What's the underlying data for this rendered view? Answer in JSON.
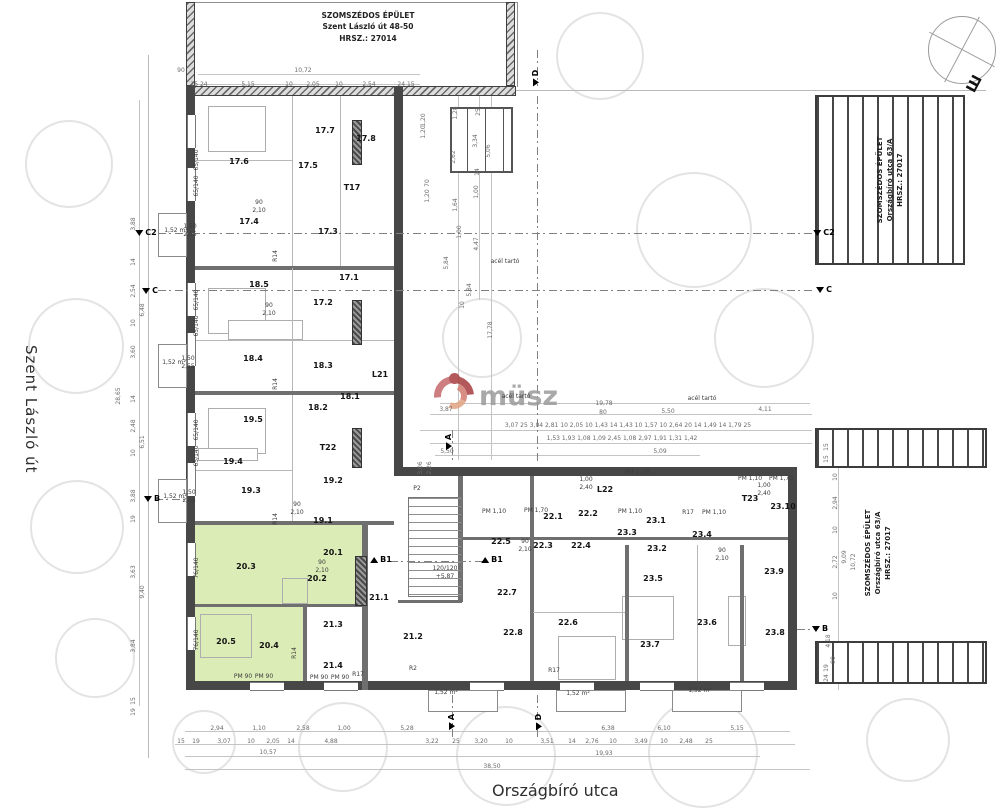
{
  "streets": {
    "left": "Szent László út",
    "bottom": "Országbíró utca"
  },
  "neighbor_top": {
    "l1": "SZOMSZÉDOS ÉPÜLET",
    "l2": "Szent László út 48-50",
    "l3": "HRSZ.: 27014"
  },
  "neighbor_right": {
    "l1": "SZOMSZÉDOS ÉPÜLET",
    "l2": "Országbíró utca 63/A",
    "l3": "HRSZ.: 27017"
  },
  "watermark": {
    "text": "müsz"
  },
  "rooms": [
    {
      "t": "17.1",
      "x": 349,
      "y": 278
    },
    {
      "t": "17.2",
      "x": 323,
      "y": 303
    },
    {
      "t": "17.3",
      "x": 328,
      "y": 232
    },
    {
      "t": "17.4",
      "x": 249,
      "y": 222
    },
    {
      "t": "17.5",
      "x": 308,
      "y": 166
    },
    {
      "t": "17.6",
      "x": 239,
      "y": 162
    },
    {
      "t": "17.7",
      "x": 325,
      "y": 131
    },
    {
      "t": "17.8",
      "x": 366,
      "y": 139
    },
    {
      "t": "T17",
      "x": 352,
      "y": 188
    },
    {
      "t": "18.1",
      "x": 350,
      "y": 397
    },
    {
      "t": "18.2",
      "x": 318,
      "y": 408
    },
    {
      "t": "18.3",
      "x": 323,
      "y": 366
    },
    {
      "t": "18.4",
      "x": 253,
      "y": 359
    },
    {
      "t": "18.5",
      "x": 259,
      "y": 285
    },
    {
      "t": "L21",
      "x": 380,
      "y": 375
    },
    {
      "t": "19.1",
      "x": 323,
      "y": 521
    },
    {
      "t": "19.2",
      "x": 333,
      "y": 481
    },
    {
      "t": "19.3",
      "x": 251,
      "y": 491
    },
    {
      "t": "19.4",
      "x": 233,
      "y": 462
    },
    {
      "t": "19.5",
      "x": 253,
      "y": 420
    },
    {
      "t": "T22",
      "x": 328,
      "y": 448
    },
    {
      "t": "20.1",
      "x": 333,
      "y": 553
    },
    {
      "t": "20.2",
      "x": 317,
      "y": 579
    },
    {
      "t": "20.3",
      "x": 246,
      "y": 567
    },
    {
      "t": "20.4",
      "x": 269,
      "y": 646
    },
    {
      "t": "20.5",
      "x": 226,
      "y": 642
    },
    {
      "t": "21.1",
      "x": 379,
      "y": 598
    },
    {
      "t": "21.2",
      "x": 413,
      "y": 637
    },
    {
      "t": "21.3",
      "x": 333,
      "y": 625
    },
    {
      "t": "21.4",
      "x": 333,
      "y": 666
    },
    {
      "t": "22.1",
      "x": 553,
      "y": 517
    },
    {
      "t": "22.2",
      "x": 588,
      "y": 514
    },
    {
      "t": "22.3",
      "x": 543,
      "y": 546
    },
    {
      "t": "22.4",
      "x": 581,
      "y": 546
    },
    {
      "t": "22.5",
      "x": 501,
      "y": 542
    },
    {
      "t": "22.6",
      "x": 568,
      "y": 623
    },
    {
      "t": "22.7",
      "x": 507,
      "y": 593
    },
    {
      "t": "22.8",
      "x": 513,
      "y": 633
    },
    {
      "t": "L22",
      "x": 605,
      "y": 490
    },
    {
      "t": "23.1",
      "x": 656,
      "y": 521
    },
    {
      "t": "23.2",
      "x": 657,
      "y": 549
    },
    {
      "t": "23.3",
      "x": 627,
      "y": 533
    },
    {
      "t": "23.4",
      "x": 702,
      "y": 535
    },
    {
      "t": "23.5",
      "x": 653,
      "y": 579
    },
    {
      "t": "23.6",
      "x": 707,
      "y": 623
    },
    {
      "t": "23.7",
      "x": 650,
      "y": 645
    },
    {
      "t": "23.8",
      "x": 775,
      "y": 633
    },
    {
      "t": "23.9",
      "x": 774,
      "y": 572
    },
    {
      "t": "23.10",
      "x": 783,
      "y": 507
    },
    {
      "t": "T23",
      "x": 750,
      "y": 499
    }
  ],
  "markers": [
    {
      "t": "C2",
      "x": 146,
      "y": 233
    },
    {
      "t": "C",
      "x": 150,
      "y": 291
    },
    {
      "t": "B",
      "x": 152,
      "y": 499
    },
    {
      "t": "C2",
      "x": 824,
      "y": 233
    },
    {
      "t": "C",
      "x": 824,
      "y": 290
    },
    {
      "t": "B",
      "x": 820,
      "y": 629
    },
    {
      "t": "B1",
      "x": 381,
      "y": 560,
      "c": "up"
    },
    {
      "t": "B1",
      "x": 492,
      "y": 560,
      "c": "up"
    },
    {
      "t": "A",
      "x": 449,
      "y": 442,
      "r": -90
    },
    {
      "t": "A",
      "x": 452,
      "y": 722,
      "r": -90
    },
    {
      "t": "D",
      "x": 539,
      "y": 722,
      "r": -90
    },
    {
      "t": "D",
      "x": 536,
      "y": 78,
      "r": -90
    }
  ],
  "texts": [
    {
      "t": "10,72",
      "x": 303,
      "y": 71,
      "c": "dim"
    },
    {
      "t": "90",
      "x": 181,
      "y": 71,
      "c": "dim"
    },
    {
      "t": "15 24",
      "x": 199,
      "y": 85,
      "c": "dim"
    },
    {
      "t": "5,15",
      "x": 248,
      "y": 85,
      "c": "dim"
    },
    {
      "t": "10",
      "x": 289,
      "y": 85,
      "c": "dim"
    },
    {
      "t": "2,05",
      "x": 313,
      "y": 85,
      "c": "dim"
    },
    {
      "t": "10",
      "x": 339,
      "y": 85,
      "c": "dim"
    },
    {
      "t": "2,54",
      "x": 369,
      "y": 85,
      "c": "dim"
    },
    {
      "t": "24 15",
      "x": 406,
      "y": 85,
      "c": "dim"
    },
    {
      "t": "2,94",
      "x": 217,
      "y": 729,
      "c": "dim"
    },
    {
      "t": "1,10",
      "x": 259,
      "y": 729,
      "c": "dim"
    },
    {
      "t": "2,58",
      "x": 303,
      "y": 729,
      "c": "dim"
    },
    {
      "t": "1,00",
      "x": 344,
      "y": 729,
      "c": "dim"
    },
    {
      "t": "5,28",
      "x": 407,
      "y": 729,
      "c": "dim"
    },
    {
      "t": "6,38",
      "x": 608,
      "y": 729,
      "c": "dim"
    },
    {
      "t": "6,10",
      "x": 664,
      "y": 729,
      "c": "dim"
    },
    {
      "t": "5,15",
      "x": 737,
      "y": 729,
      "c": "dim"
    },
    {
      "t": "15",
      "x": 181,
      "y": 742,
      "c": "dim"
    },
    {
      "t": "19",
      "x": 196,
      "y": 742,
      "c": "dim"
    },
    {
      "t": "3,07",
      "x": 224,
      "y": 742,
      "c": "dim"
    },
    {
      "t": "10",
      "x": 251,
      "y": 742,
      "c": "dim"
    },
    {
      "t": "2,05",
      "x": 273,
      "y": 742,
      "c": "dim"
    },
    {
      "t": "14",
      "x": 291,
      "y": 742,
      "c": "dim"
    },
    {
      "t": "4,88",
      "x": 331,
      "y": 742,
      "c": "dim"
    },
    {
      "t": "3,22",
      "x": 432,
      "y": 742,
      "c": "dim"
    },
    {
      "t": "25",
      "x": 456,
      "y": 742,
      "c": "dim"
    },
    {
      "t": "3,20",
      "x": 481,
      "y": 742,
      "c": "dim"
    },
    {
      "t": "10",
      "x": 509,
      "y": 742,
      "c": "dim"
    },
    {
      "t": "3,51",
      "x": 547,
      "y": 742,
      "c": "dim"
    },
    {
      "t": "14",
      "x": 572,
      "y": 742,
      "c": "dim"
    },
    {
      "t": "2,76",
      "x": 592,
      "y": 742,
      "c": "dim"
    },
    {
      "t": "10",
      "x": 613,
      "y": 742,
      "c": "dim"
    },
    {
      "t": "3,49",
      "x": 641,
      "y": 742,
      "c": "dim"
    },
    {
      "t": "10",
      "x": 664,
      "y": 742,
      "c": "dim"
    },
    {
      "t": "2,48",
      "x": 686,
      "y": 742,
      "c": "dim"
    },
    {
      "t": "25",
      "x": 709,
      "y": 742,
      "c": "dim"
    },
    {
      "t": "10,57",
      "x": 268,
      "y": 753,
      "c": "dim"
    },
    {
      "t": "19,93",
      "x": 604,
      "y": 754,
      "c": "dim"
    },
    {
      "t": "38,50",
      "x": 492,
      "y": 767,
      "c": "dim"
    },
    {
      "t": "28,65",
      "x": 119,
      "y": 396,
      "r": -90,
      "c": "dim"
    },
    {
      "t": "3,88",
      "x": 134,
      "y": 224,
      "r": -90,
      "c": "dim"
    },
    {
      "t": "14",
      "x": 134,
      "y": 262,
      "r": -90,
      "c": "dim"
    },
    {
      "t": "2,54",
      "x": 134,
      "y": 291,
      "r": -90,
      "c": "dim"
    },
    {
      "t": "6,48",
      "x": 143,
      "y": 310,
      "r": -90,
      "c": "dim"
    },
    {
      "t": "10",
      "x": 134,
      "y": 323,
      "r": -90,
      "c": "dim"
    },
    {
      "t": "3,60",
      "x": 134,
      "y": 352,
      "r": -90,
      "c": "dim"
    },
    {
      "t": "14",
      "x": 134,
      "y": 399,
      "r": -90,
      "c": "dim"
    },
    {
      "t": "2,48",
      "x": 134,
      "y": 426,
      "r": -90,
      "c": "dim"
    },
    {
      "t": "6,51",
      "x": 143,
      "y": 442,
      "r": -90,
      "c": "dim"
    },
    {
      "t": "10",
      "x": 134,
      "y": 453,
      "r": -90,
      "c": "dim"
    },
    {
      "t": "3,88",
      "x": 134,
      "y": 496,
      "r": -90,
      "c": "dim"
    },
    {
      "t": "19",
      "x": 134,
      "y": 519,
      "r": -90,
      "c": "dim"
    },
    {
      "t": "3,63",
      "x": 134,
      "y": 572,
      "r": -90,
      "c": "dim"
    },
    {
      "t": "9,40",
      "x": 143,
      "y": 592,
      "r": -90,
      "c": "dim"
    },
    {
      "t": "3,84",
      "x": 134,
      "y": 646,
      "r": -90,
      "c": "dim"
    },
    {
      "t": "15",
      "x": 134,
      "y": 701,
      "r": -90,
      "c": "dim"
    },
    {
      "t": "19",
      "x": 134,
      "y": 712,
      "r": -90,
      "c": "dim"
    },
    {
      "t": "15",
      "x": 827,
      "y": 447,
      "r": -90,
      "c": "dim"
    },
    {
      "t": "15",
      "x": 827,
      "y": 459,
      "r": -90,
      "c": "dim"
    },
    {
      "t": "10",
      "x": 836,
      "y": 477,
      "r": -90,
      "c": "dim"
    },
    {
      "t": "2,94",
      "x": 836,
      "y": 503,
      "r": -90,
      "c": "dim"
    },
    {
      "t": "10",
      "x": 836,
      "y": 530,
      "r": -90,
      "c": "dim"
    },
    {
      "t": "2,72",
      "x": 836,
      "y": 562,
      "r": -90,
      "c": "dim"
    },
    {
      "t": "9,09",
      "x": 845,
      "y": 557,
      "r": -90,
      "c": "dim"
    },
    {
      "t": "10,72",
      "x": 854,
      "y": 562,
      "r": -90,
      "c": "dim"
    },
    {
      "t": "10",
      "x": 836,
      "y": 596,
      "r": -90,
      "c": "dim"
    },
    {
      "t": "4,18",
      "x": 829,
      "y": 641,
      "r": -90,
      "c": "dim"
    },
    {
      "t": "90",
      "x": 834,
      "y": 660,
      "r": -90,
      "c": "dim"
    },
    {
      "t": "19",
      "x": 827,
      "y": 668,
      "r": -90,
      "c": "dim"
    },
    {
      "t": "24",
      "x": 827,
      "y": 678,
      "r": -90,
      "c": "dim"
    },
    {
      "t": "1,28",
      "x": 456,
      "y": 113,
      "r": -90,
      "c": "dim"
    },
    {
      "t": "25",
      "x": 479,
      "y": 112,
      "r": -90,
      "c": "dim"
    },
    {
      "t": "2,62",
      "x": 454,
      "y": 157,
      "r": -90,
      "c": "dim"
    },
    {
      "t": "3,34",
      "x": 476,
      "y": 141,
      "r": -90,
      "c": "dim"
    },
    {
      "t": "5,06",
      "x": 489,
      "y": 151,
      "r": -90,
      "c": "dim"
    },
    {
      "t": "14",
      "x": 478,
      "y": 172,
      "r": -90,
      "c": "dim"
    },
    {
      "t": "1,00",
      "x": 477,
      "y": 192,
      "r": -90,
      "c": "dim"
    },
    {
      "t": "1,64",
      "x": 456,
      "y": 205,
      "r": -90,
      "c": "dim"
    },
    {
      "t": "1,20",
      "x": 424,
      "y": 120,
      "r": -90,
      "c": "dim"
    },
    {
      "t": "1,20",
      "x": 424,
      "y": 132,
      "r": -90,
      "c": "dim"
    },
    {
      "t": "70",
      "x": 428,
      "y": 183,
      "r": -90,
      "c": "dim"
    },
    {
      "t": "1,20",
      "x": 428,
      "y": 196,
      "r": -90,
      "c": "dim"
    },
    {
      "t": "4,47",
      "x": 477,
      "y": 244,
      "r": -90,
      "c": "dim"
    },
    {
      "t": "1,00",
      "x": 460,
      "y": 232,
      "r": -90,
      "c": "dim"
    },
    {
      "t": "5,84",
      "x": 447,
      "y": 263,
      "r": -90,
      "c": "dim"
    },
    {
      "t": "5,84",
      "x": 470,
      "y": 290,
      "r": -90,
      "c": "dim"
    },
    {
      "t": "17,78",
      "x": 491,
      "y": 330,
      "r": -90,
      "c": "dim"
    },
    {
      "t": "10",
      "x": 463,
      "y": 305,
      "r": -90,
      "c": "dim"
    },
    {
      "t": "acél tartó",
      "x": 516,
      "y": 397,
      "c": "ann"
    },
    {
      "t": "acél tartó",
      "x": 702,
      "y": 399,
      "c": "ann"
    },
    {
      "t": "acél tartó",
      "x": 505,
      "y": 262,
      "c": "ann"
    },
    {
      "t": "19,78",
      "x": 604,
      "y": 404,
      "c": "dim"
    },
    {
      "t": "80",
      "x": 603,
      "y": 413,
      "c": "dim"
    },
    {
      "t": "5,50",
      "x": 668,
      "y": 412,
      "c": "dim"
    },
    {
      "t": "4,11",
      "x": 765,
      "y": 410,
      "c": "dim"
    },
    {
      "t": "3,87",
      "x": 446,
      "y": 410,
      "c": "dim"
    },
    {
      "t": "3,07  25  3,04  2,81  10  2,05  10  1,43  14  1,43  10  1,57  10  2,64  20  14  1,49  14  1,79  25",
      "x": 628,
      "y": 426,
      "c": "dim"
    },
    {
      "t": "1,53     1,93     1,08    1,09     2,45     1,08     2,97     1,91     1,31     1,42",
      "x": 622,
      "y": 439,
      "c": "dim"
    },
    {
      "t": "5,50",
      "x": 447,
      "y": 452,
      "c": "dim"
    },
    {
      "t": "5,09",
      "x": 660,
      "y": 452,
      "c": "dim"
    },
    {
      "t": "3,06",
      "x": 421,
      "y": 468,
      "r": -90,
      "c": "dim"
    },
    {
      "t": "2,26",
      "x": 430,
      "y": 468,
      "r": -90,
      "c": "dim"
    },
    {
      "t": "PM 90",
      "x": 243,
      "y": 677,
      "c": "ann"
    },
    {
      "t": "PM 90",
      "x": 264,
      "y": 677,
      "c": "ann"
    },
    {
      "t": "PM 90",
      "x": 319,
      "y": 678,
      "c": "ann"
    },
    {
      "t": "PM 90",
      "x": 340,
      "y": 678,
      "c": "ann"
    },
    {
      "t": "PM 1,10",
      "x": 494,
      "y": 512,
      "c": "ann"
    },
    {
      "t": "PM 1,70",
      "x": 536,
      "y": 511,
      "c": "ann"
    },
    {
      "t": "PM 1,10",
      "x": 630,
      "y": 512,
      "c": "ann"
    },
    {
      "t": "PM 1,10",
      "x": 714,
      "y": 513,
      "c": "ann"
    },
    {
      "t": "PM 1,10",
      "x": 750,
      "y": 479,
      "c": "ann"
    },
    {
      "t": "PM 1,70",
      "x": 781,
      "y": 479,
      "c": "ann"
    },
    {
      "t": "PM 1,10",
      "x": 637,
      "y": 473,
      "c": "ann"
    },
    {
      "t": "R14",
      "x": 276,
      "y": 256,
      "r": -90,
      "c": "ann"
    },
    {
      "t": "R14",
      "x": 276,
      "y": 384,
      "r": -90,
      "c": "ann"
    },
    {
      "t": "R14",
      "x": 276,
      "y": 519,
      "r": -90,
      "c": "ann"
    },
    {
      "t": "R14",
      "x": 295,
      "y": 653,
      "r": -90,
      "c": "ann"
    },
    {
      "t": "R17",
      "x": 358,
      "y": 675,
      "c": "ann"
    },
    {
      "t": "R17",
      "x": 554,
      "y": 671,
      "c": "ann"
    },
    {
      "t": "R17",
      "x": 688,
      "y": 513,
      "c": "ann"
    },
    {
      "t": "R2",
      "x": 413,
      "y": 669,
      "c": "ann"
    },
    {
      "t": "P2",
      "x": 417,
      "y": 489,
      "c": "ann"
    },
    {
      "t": "120/120",
      "x": 445,
      "y": 569,
      "c": "ann"
    },
    {
      "t": "+5,87",
      "x": 445,
      "y": 577,
      "c": "ann"
    },
    {
      "t": "1,52 m²",
      "x": 446,
      "y": 693,
      "c": "ann"
    },
    {
      "t": "1,52 m²",
      "x": 578,
      "y": 694,
      "c": "ann"
    },
    {
      "t": "1,52 m²",
      "x": 700,
      "y": 691,
      "c": "ann"
    },
    {
      "t": "1,52 m²",
      "x": 176,
      "y": 231,
      "c": "ann"
    },
    {
      "t": "1,52 m²",
      "x": 174,
      "y": 363,
      "c": "ann"
    },
    {
      "t": "1,52 m²",
      "x": 175,
      "y": 497,
      "c": "ann"
    },
    {
      "t": "1,50",
      "x": 190,
      "y": 227,
      "c": "ann"
    },
    {
      "t": "2,55",
      "x": 190,
      "y": 235,
      "c": "ann"
    },
    {
      "t": "1,50",
      "x": 188,
      "y": 359,
      "c": "ann"
    },
    {
      "t": "2,55",
      "x": 188,
      "y": 367,
      "c": "ann"
    },
    {
      "t": "1,50",
      "x": 189,
      "y": 493,
      "c": "ann"
    },
    {
      "t": "2,55",
      "x": 189,
      "y": 501,
      "c": "ann"
    },
    {
      "t": "65/140",
      "x": 197,
      "y": 160,
      "r": -90,
      "c": "ann"
    },
    {
      "t": "65/140",
      "x": 197,
      "y": 186,
      "r": -90,
      "c": "ann"
    },
    {
      "t": "65/140",
      "x": 197,
      "y": 300,
      "r": -90,
      "c": "ann"
    },
    {
      "t": "65/140",
      "x": 197,
      "y": 326,
      "r": -90,
      "c": "ann"
    },
    {
      "t": "65/140",
      "x": 197,
      "y": 430,
      "r": -90,
      "c": "ann"
    },
    {
      "t": "65/140",
      "x": 197,
      "y": 456,
      "r": -90,
      "c": "ann"
    },
    {
      "t": "76/140",
      "x": 197,
      "y": 568,
      "r": -90,
      "c": "ann"
    },
    {
      "t": "76/140",
      "x": 197,
      "y": 640,
      "r": -90,
      "c": "ann"
    },
    {
      "t": "90",
      "x": 259,
      "y": 203,
      "c": "ann"
    },
    {
      "t": "2,10",
      "x": 259,
      "y": 211,
      "c": "ann"
    },
    {
      "t": "90",
      "x": 269,
      "y": 306,
      "c": "ann"
    },
    {
      "t": "2,10",
      "x": 269,
      "y": 314,
      "c": "ann"
    },
    {
      "t": "90",
      "x": 297,
      "y": 505,
      "c": "ann"
    },
    {
      "t": "2,10",
      "x": 297,
      "y": 513,
      "c": "ann"
    },
    {
      "t": "90",
      "x": 322,
      "y": 563,
      "c": "ann"
    },
    {
      "t": "2,10",
      "x": 322,
      "y": 571,
      "c": "ann"
    },
    {
      "t": "90",
      "x": 525,
      "y": 542,
      "c": "ann"
    },
    {
      "t": "2,10",
      "x": 525,
      "y": 550,
      "c": "ann"
    },
    {
      "t": "90",
      "x": 722,
      "y": 551,
      "c": "ann"
    },
    {
      "t": "2,10",
      "x": 722,
      "y": 559,
      "c": "ann"
    },
    {
      "t": "1,00",
      "x": 586,
      "y": 480,
      "c": "ann"
    },
    {
      "t": "2,40",
      "x": 586,
      "y": 488,
      "c": "ann"
    },
    {
      "t": "1,00",
      "x": 764,
      "y": 486,
      "c": "ann"
    },
    {
      "t": "2,40",
      "x": 764,
      "y": 494,
      "c": "ann"
    }
  ]
}
